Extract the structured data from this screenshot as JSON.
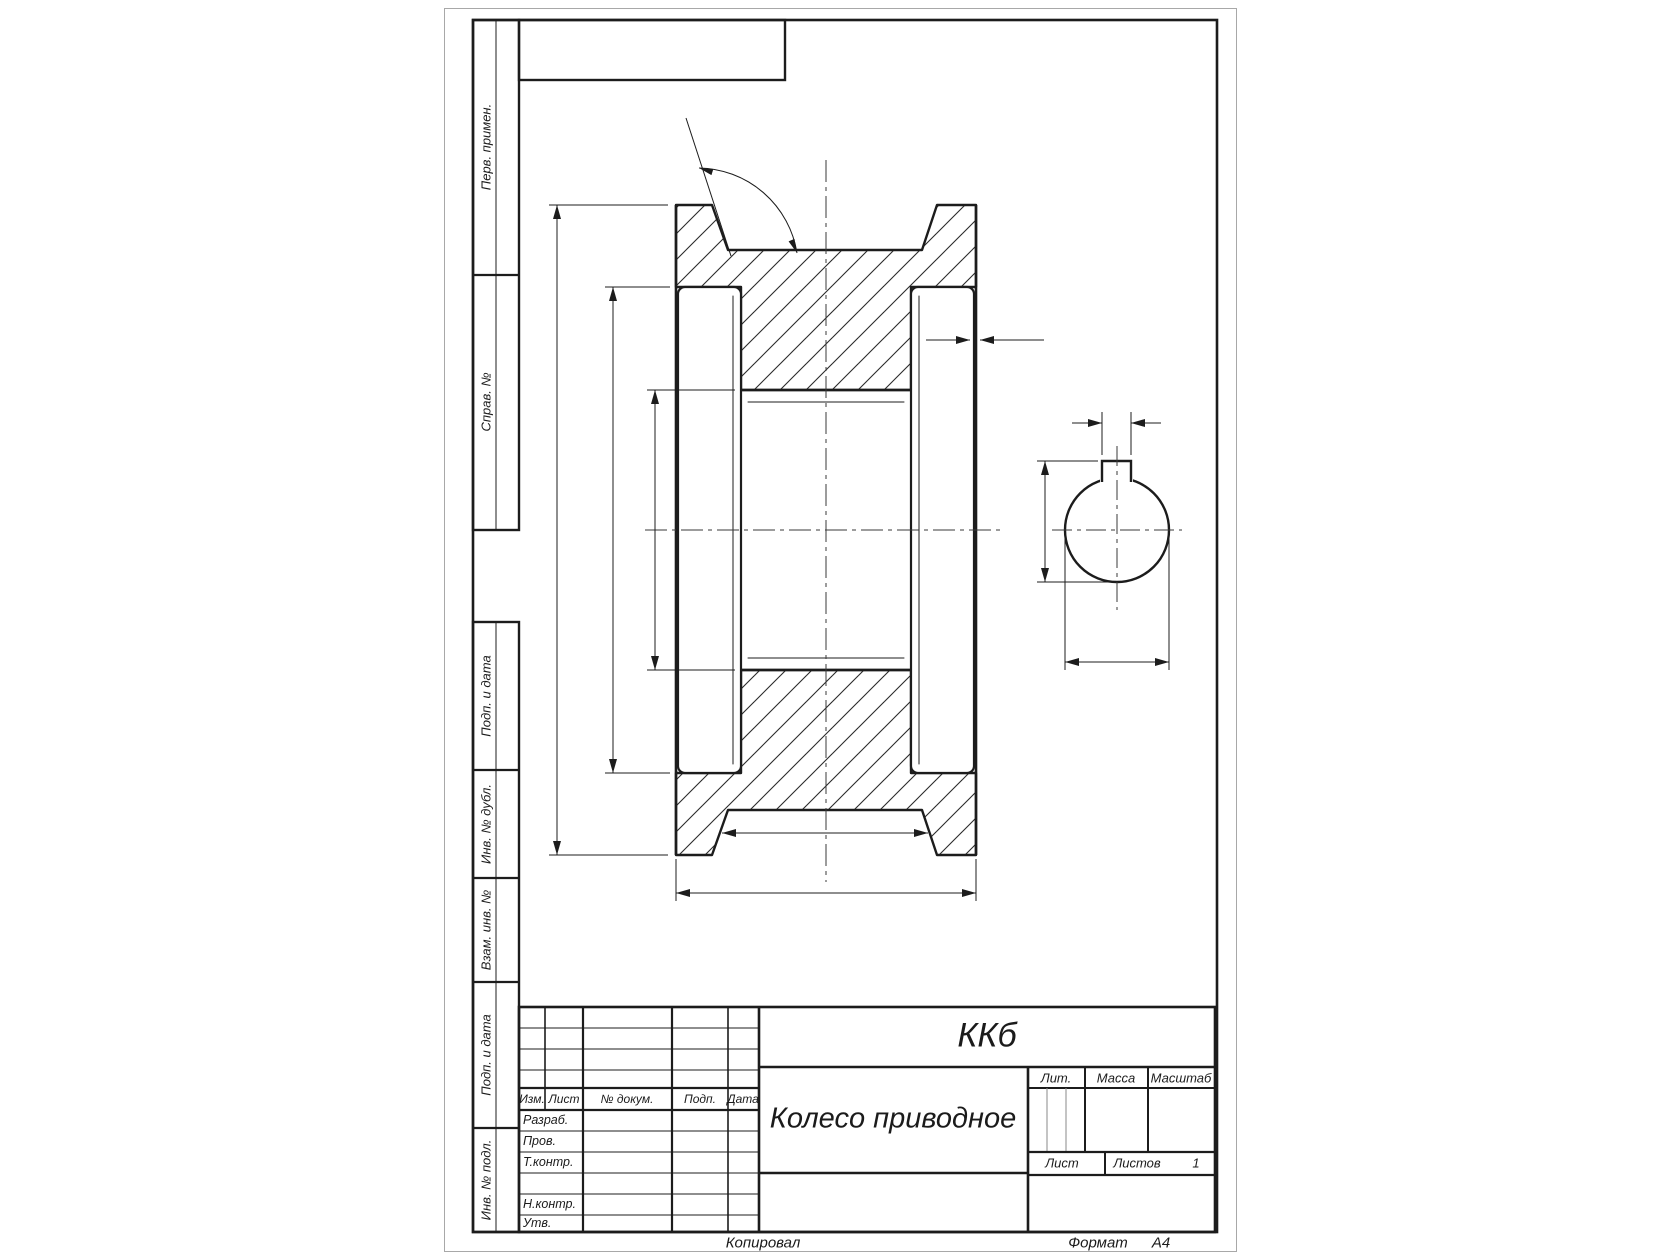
{
  "meta": {
    "document_type": "GOST engineering drawing sheet",
    "ink_color": "#1c1c1c",
    "page_edge_color": "#a8a8a8"
  },
  "side_column": {
    "items": [
      {
        "label": "Перв. примен."
      },
      {
        "label": "Справ. №"
      },
      {
        "label": "Подп. и дата"
      },
      {
        "label": "Инв. № дубл."
      },
      {
        "label": "Взам. инв. №"
      },
      {
        "label": "Подп. и дата"
      },
      {
        "label": "Инв. № подл."
      }
    ]
  },
  "title_block": {
    "designation": "ККб",
    "part_name": "Колесо приводное",
    "header_cols": {
      "izm": "Изм.",
      "list": "Лист",
      "doc": "№ докум.",
      "podp": "Подп.",
      "data": "Дата"
    },
    "roles": {
      "razrab": "Разраб.",
      "prov": "Пров.",
      "tkontr": "Т.контр.",
      "nkontr": "Н.контр.",
      "utv": "Утв."
    },
    "right": {
      "lit_label": "Лит.",
      "mass_label": "Масса",
      "scale_label": "Масштаб",
      "sheet_label": "Лист",
      "sheets_label": "Листов",
      "sheets_value": "1"
    }
  },
  "footer": {
    "copied_label": "Копировал",
    "format_label": "Формат",
    "format_value": "А4"
  },
  "drawing": {
    "views": {
      "main": "wheel axial cross-section with rope groove, hub bosses and bore",
      "side": "bore end view with keyway slot"
    },
    "dimension_values_shown": "none (dimension lines drawn without numbers)"
  }
}
